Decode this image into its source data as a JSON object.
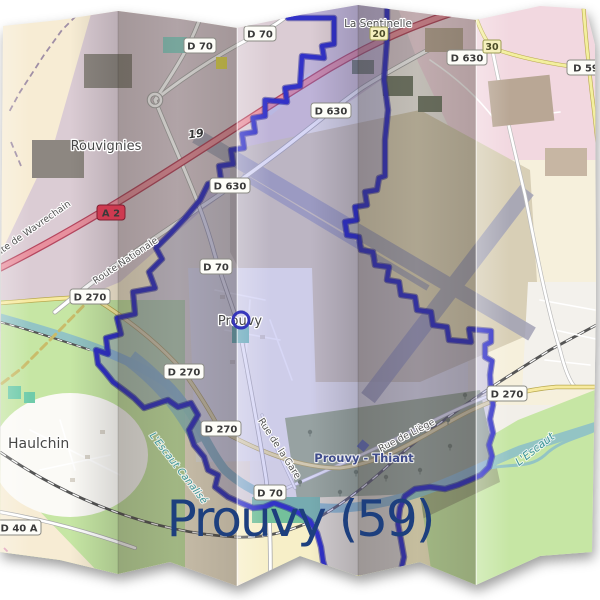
{
  "title": {
    "text": "Prouvy (59)",
    "color": "#1d3f7e"
  },
  "places": [
    {
      "id": "rouvignies",
      "name": "Rouvignies"
    },
    {
      "id": "la-sentinelle",
      "name": "La Sentinelle"
    },
    {
      "id": "prouvy",
      "name": "Prouvy"
    },
    {
      "id": "haulchin",
      "name": "Haulchin"
    }
  ],
  "station": {
    "name": "Prouvy - Thiant"
  },
  "streets": [
    {
      "id": "wavrechain",
      "name": "Route de Wavrechain"
    },
    {
      "id": "nationale",
      "name": "Route Nationale"
    },
    {
      "id": "gare",
      "name": "Rue de la Gare"
    },
    {
      "id": "liege",
      "name": "Rue de Liège"
    }
  ],
  "waterways": [
    {
      "id": "canal",
      "name": "L'Escaut Canalisé"
    },
    {
      "id": "escaut",
      "name": "L'Escaut"
    }
  ],
  "shields": [
    {
      "label": "D 70"
    },
    {
      "label": "D 70"
    },
    {
      "label": "D 630"
    },
    {
      "label": "D 630"
    },
    {
      "label": "D 630"
    },
    {
      "label": "A 2"
    },
    {
      "label": "D 270"
    },
    {
      "label": "D 70"
    },
    {
      "label": "D 270"
    },
    {
      "label": "D 270"
    },
    {
      "label": "D 270"
    },
    {
      "label": "D 40 A"
    },
    {
      "label": "D 70"
    },
    {
      "label": "D 59"
    }
  ],
  "exit_numbers": [
    {
      "label": "19"
    },
    {
      "label": "20"
    },
    {
      "label": "30"
    }
  ],
  "colors": {
    "title": "#1d3f7e",
    "boundary_stroke": "#3232c8",
    "boundary_casing": "#1c1c96",
    "commune_fill": "rgba(124,124,226,0.30)",
    "motorway": "#e8909e",
    "motorway_casing": "#b5475f",
    "water": "#93c4c4",
    "grass": "#c6e6a4",
    "wood": "#a4b487",
    "farmland": "#f6f0dc",
    "retail": "#f2d8e0",
    "industrial": "#dbccd4",
    "airport": "#d8cfb6",
    "runway": "#a2a2b6",
    "sand": "#f7efc8",
    "cream": "#f7ecd4",
    "yellow_road": "#f7eaa0",
    "a2_badge": "#ce3a50"
  }
}
